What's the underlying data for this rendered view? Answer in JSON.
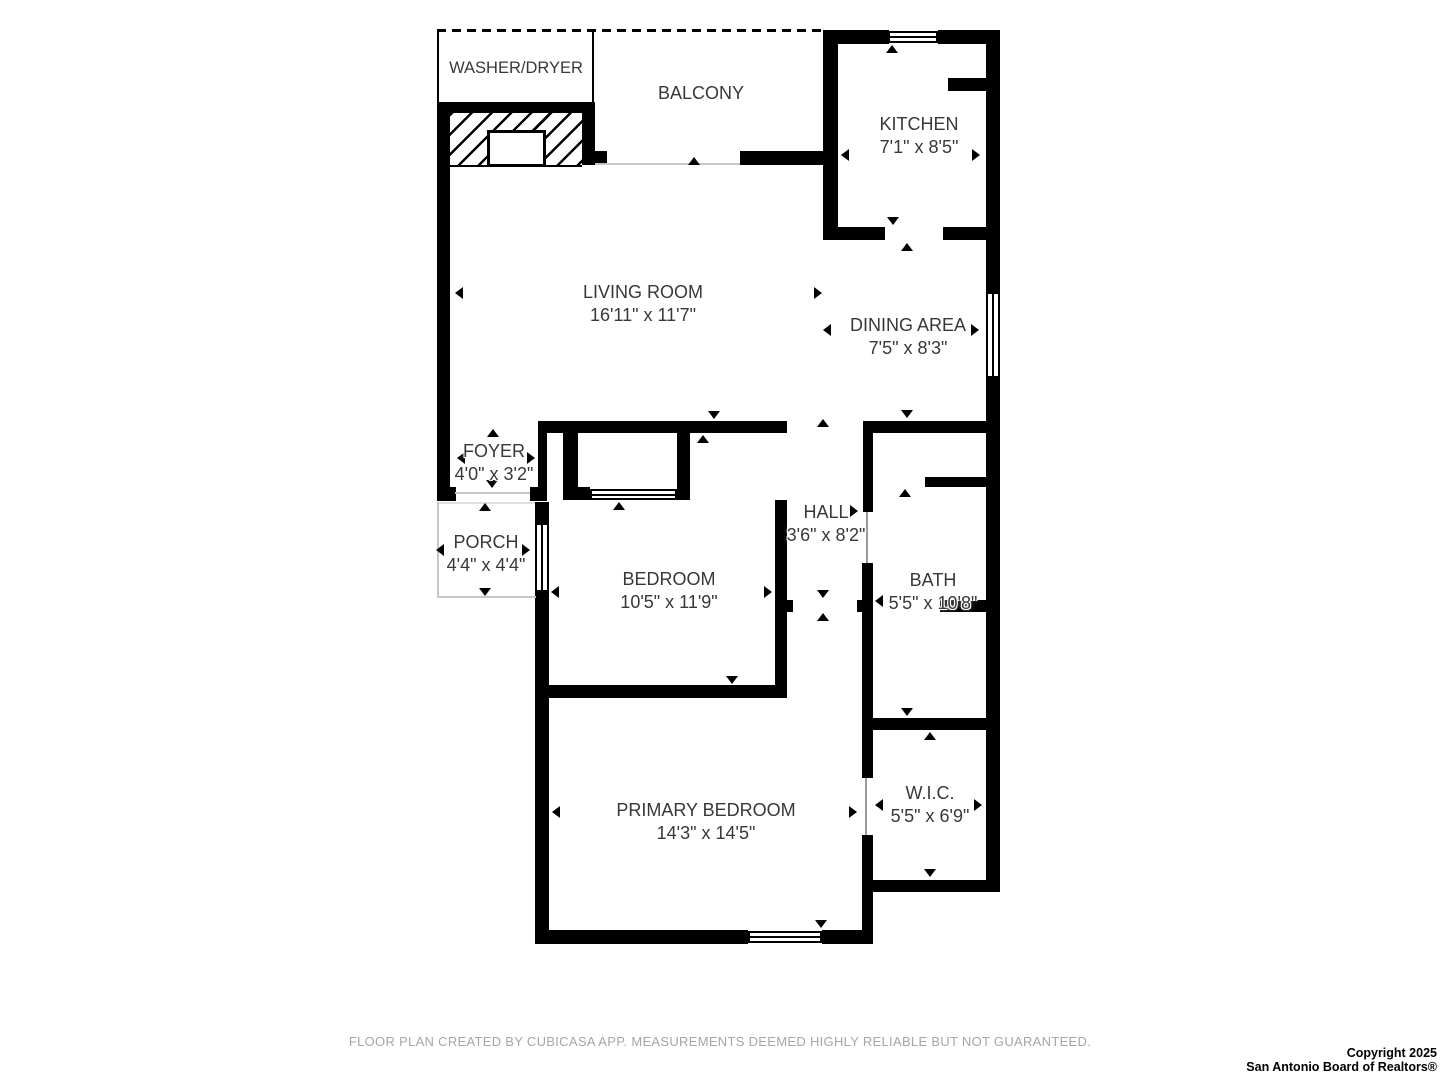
{
  "rooms": {
    "washer_dryer": {
      "name": "WASHER/DRYER",
      "dims": ""
    },
    "balcony": {
      "name": "BALCONY",
      "dims": ""
    },
    "kitchen": {
      "name": "KITCHEN",
      "dims": "7'1\" x 8'5\""
    },
    "living_room": {
      "name": "LIVING ROOM",
      "dims": "16'11\" x 11'7\""
    },
    "dining_area": {
      "name": "DINING AREA",
      "dims": "7'5\" x 8'3\""
    },
    "foyer": {
      "name": "FOYER",
      "dims": "4'0\" x 3'2\""
    },
    "porch": {
      "name": "PORCH",
      "dims": "4'4\" x 4'4\""
    },
    "hall": {
      "name": "HALL",
      "dims": "3'6\" x 8'2\""
    },
    "bedroom": {
      "name": "BEDROOM",
      "dims": "10'5\" x 11'9\""
    },
    "bath": {
      "name": "BATH",
      "dims": "5'5\" x 10'8\""
    },
    "primary_bedroom": {
      "name": "PRIMARY BEDROOM",
      "dims": "14'3\" x 14'5\""
    },
    "wic": {
      "name": "W.I.C.",
      "dims": "5'5\" x 6'9\""
    }
  },
  "footer": {
    "disclaimer": "FLOOR PLAN CREATED BY CUBICASA APP. MEASUREMENTS DEEMED HIGHLY RELIABLE BUT NOT GUARANTEED."
  },
  "copyright": {
    "line1": "Copyright 2025",
    "line2": "San Antonio Board of Realtors®"
  },
  "colors": {
    "wall": "#000000",
    "label_text": "#383838",
    "disclaimer_text": "#a6a6a6",
    "slider_line": "#c6c6c6"
  }
}
